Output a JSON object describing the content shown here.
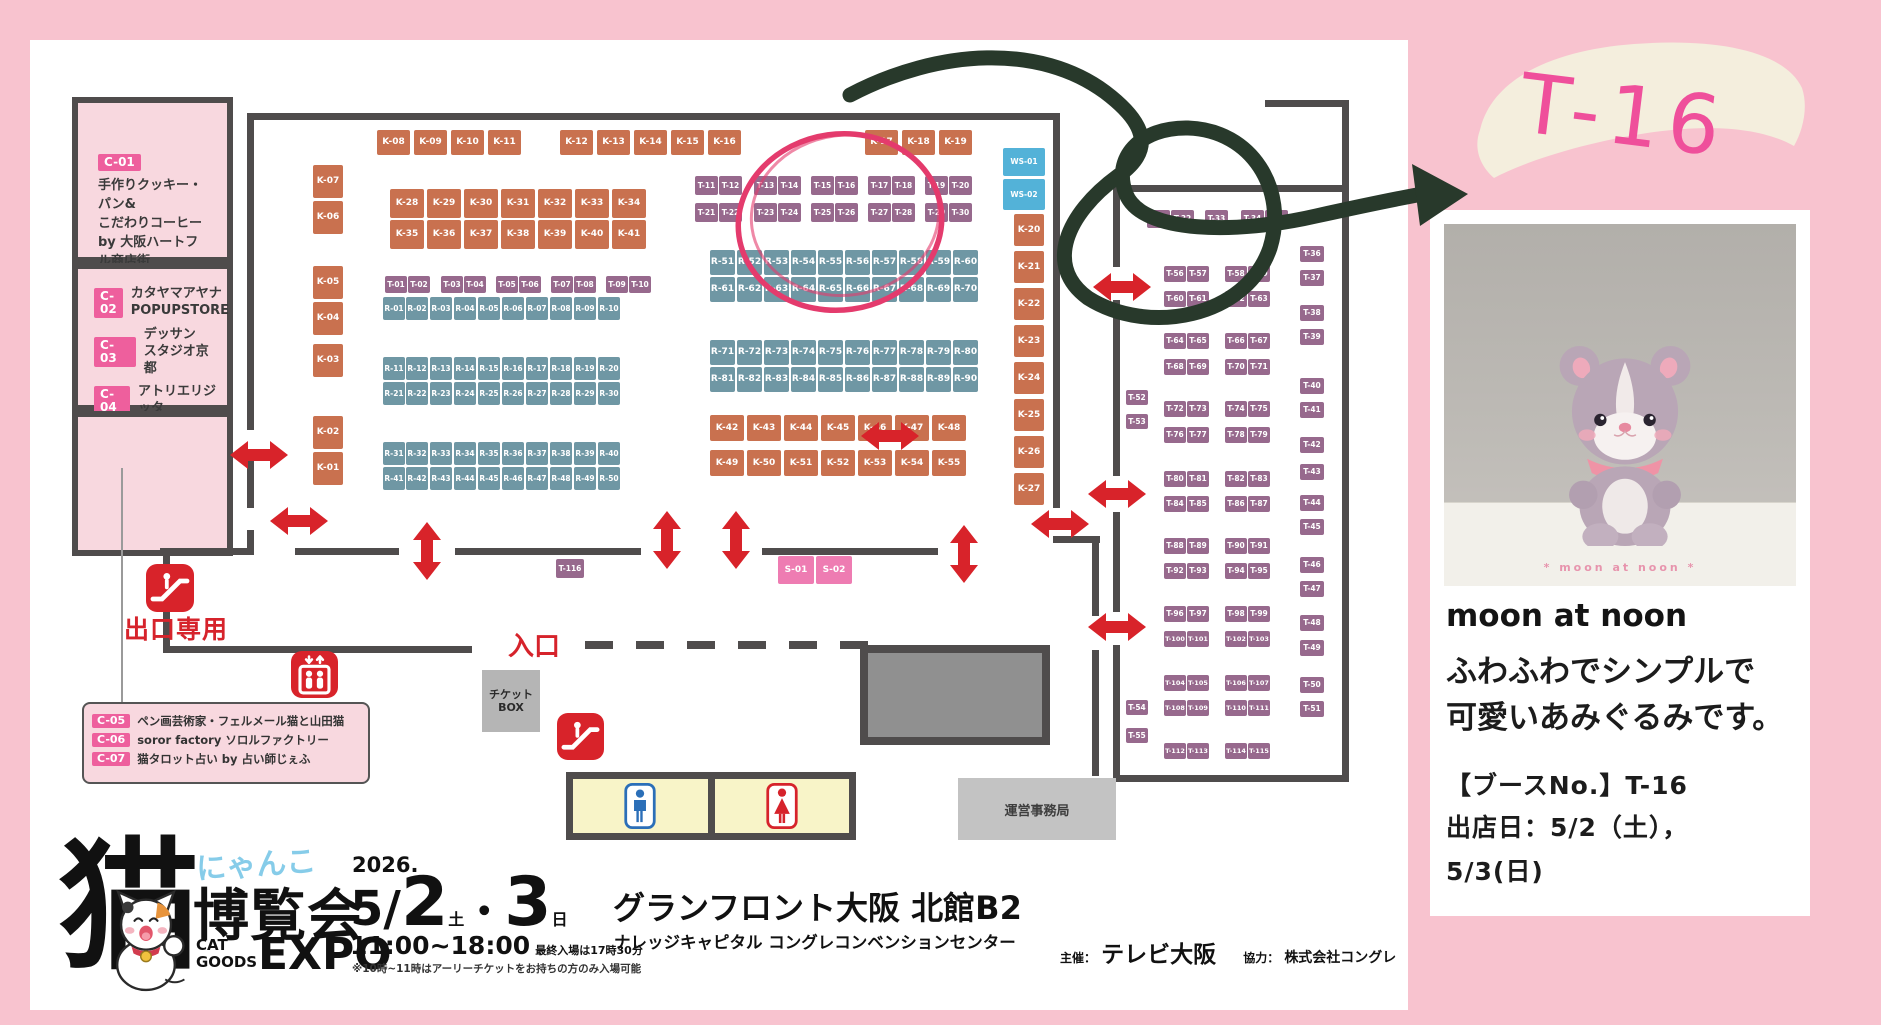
{
  "colors": {
    "k": "#c9714f",
    "r": "#6f97a4",
    "t": "#97698d",
    "ws": "#53b2d8",
    "s": "#ee7cb2",
    "wall": "#4f4c4c",
    "red": "#d8232a",
    "pink_room": "#f8d8df",
    "badge": "#ee5f9d",
    "background": "#f8c3cf",
    "accent_pink": "#ef4f9b",
    "green_marker": "#28392b",
    "red_marker": "#e43b6d"
  },
  "rooms": {
    "c01": {
      "badge": "C-01",
      "l1": "手作りクッキー・パン&",
      "l2": "こだわりコーヒー",
      "l3": "by 大阪ハートフル商店街"
    },
    "c02": {
      "badge": "C-02",
      "l1": "カタヤマアヤナ",
      "l2": "POPUPSTORE"
    },
    "c03": {
      "badge": "C-03",
      "l1": "デッサン",
      "l2": "スタジオ京都"
    },
    "c04": {
      "badge": "C-04",
      "l1": "アトリエリジッタ"
    },
    "c05": {
      "badge": "C-05",
      "text": "ペン画芸術家・フェルメール猫と山田猫"
    },
    "c06": {
      "badge": "C-06",
      "text": "soror factory ソロルファクトリー"
    },
    "c07": {
      "badge": "C-07",
      "text": "猫タロット占い by 占い師じぇふ"
    }
  },
  "map": {
    "labels": {
      "exit": "出口専用",
      "entrance": "入口",
      "ticket1": "チケット",
      "ticket2": "BOX",
      "office": "運営事務局"
    },
    "booth_rows": [
      {
        "ids": [
          "K-08",
          "K-09",
          "K-10",
          "K-11"
        ],
        "xs": [
          377,
          414,
          451,
          488
        ],
        "y": 130,
        "w": 33,
        "h": 25,
        "t": "k"
      },
      {
        "ids": [
          "K-12",
          "K-13",
          "K-14",
          "K-15",
          "K-16"
        ],
        "xs": [
          560,
          597,
          634,
          671,
          708
        ],
        "y": 130,
        "w": 33,
        "h": 25,
        "t": "k"
      },
      {
        "ids": [
          "K-17",
          "K-18",
          "K-19"
        ],
        "xs": [
          865,
          902,
          939
        ],
        "y": 130,
        "w": 33,
        "h": 25,
        "t": "k"
      },
      {
        "ids": [
          "K-07",
          "K-06",
          "K-05",
          "K-04",
          "K-03",
          "K-02",
          "K-01"
        ],
        "x": 313,
        "ys": [
          165,
          201,
          266,
          302,
          344,
          416,
          452
        ],
        "w": 30,
        "h": 33,
        "t": "k"
      },
      {
        "ids": [
          "K-28",
          "K-29",
          "K-30",
          "K-31",
          "K-32",
          "K-33",
          "K-34"
        ],
        "xs": [
          390,
          427,
          464,
          501,
          538,
          575,
          612
        ],
        "y": 189,
        "w": 34,
        "h": 29,
        "t": "k"
      },
      {
        "ids": [
          "K-35",
          "K-36",
          "K-37",
          "K-38",
          "K-39",
          "K-40",
          "K-41"
        ],
        "xs": [
          390,
          427,
          464,
          501,
          538,
          575,
          612
        ],
        "y": 220,
        "w": 34,
        "h": 29,
        "t": "k"
      },
      {
        "ids": [
          "T-01",
          "T-02",
          "T-03",
          "T-04",
          "T-05",
          "T-06",
          "T-07",
          "T-08",
          "T-09",
          "T-10"
        ],
        "xs": [
          385,
          408,
          441,
          464,
          496,
          519,
          551,
          574,
          606,
          629
        ],
        "y": 276,
        "w": 22,
        "h": 17,
        "t": "t"
      },
      {
        "ids": [
          "R-01",
          "R-02",
          "R-03",
          "R-04",
          "R-05",
          "R-06",
          "R-07",
          "R-08",
          "R-09",
          "R-10"
        ],
        "xs": [
          383,
          406,
          430,
          454,
          478,
          502,
          526,
          550,
          574,
          598
        ],
        "y": 297,
        "w": 22,
        "h": 23,
        "t": "r"
      },
      {
        "ids": [
          "R-11",
          "R-12",
          "R-13",
          "R-14",
          "R-15",
          "R-16",
          "R-17",
          "R-18",
          "R-19",
          "R-20"
        ],
        "xs": [
          383,
          406,
          430,
          454,
          478,
          502,
          526,
          550,
          574,
          598
        ],
        "y": 357,
        "w": 22,
        "h": 23,
        "t": "r"
      },
      {
        "ids": [
          "R-21",
          "R-22",
          "R-23",
          "R-24",
          "R-25",
          "R-26",
          "R-27",
          "R-28",
          "R-29",
          "R-30"
        ],
        "xs": [
          383,
          406,
          430,
          454,
          478,
          502,
          526,
          550,
          574,
          598
        ],
        "y": 382,
        "w": 22,
        "h": 23,
        "t": "r"
      },
      {
        "ids": [
          "R-31",
          "R-32",
          "R-33",
          "R-34",
          "R-35",
          "R-36",
          "R-37",
          "R-38",
          "R-39",
          "R-40"
        ],
        "xs": [
          383,
          406,
          430,
          454,
          478,
          502,
          526,
          550,
          574,
          598
        ],
        "y": 442,
        "w": 22,
        "h": 23,
        "t": "r"
      },
      {
        "ids": [
          "R-41",
          "R-42",
          "R-43",
          "R-44",
          "R-45",
          "R-46",
          "R-47",
          "R-48",
          "R-49",
          "R-50"
        ],
        "xs": [
          383,
          406,
          430,
          454,
          478,
          502,
          526,
          550,
          574,
          598
        ],
        "y": 467,
        "w": 22,
        "h": 23,
        "t": "r"
      },
      {
        "ids": [
          "T-11",
          "T-12",
          "T-13",
          "T-14",
          "T-15",
          "T-16",
          "T-17",
          "T-18",
          "T-19",
          "T-20"
        ],
        "xs": [
          695,
          719,
          754,
          778,
          811,
          835,
          868,
          892,
          925,
          949
        ],
        "y": 176,
        "w": 23,
        "h": 19,
        "t": "t"
      },
      {
        "ids": [
          "T-21",
          "T-22",
          "T-23",
          "T-24",
          "T-25",
          "T-26",
          "T-27",
          "T-28",
          "T-29",
          "T-30"
        ],
        "xs": [
          695,
          719,
          754,
          778,
          811,
          835,
          868,
          892,
          925,
          949
        ],
        "y": 203,
        "w": 23,
        "h": 19,
        "t": "t"
      },
      {
        "ids": [
          "R-51",
          "R-52",
          "R-53",
          "R-54",
          "R-55",
          "R-56",
          "R-57",
          "R-58",
          "R-59",
          "R-60"
        ],
        "xs": [
          710,
          737,
          764,
          791,
          818,
          845,
          872,
          899,
          926,
          953
        ],
        "y": 250,
        "w": 25,
        "h": 25,
        "t": "r"
      },
      {
        "ids": [
          "R-61",
          "R-62",
          "R-63",
          "R-64",
          "R-65",
          "R-66",
          "R-67",
          "R-68",
          "R-69",
          "R-70"
        ],
        "xs": [
          710,
          737,
          764,
          791,
          818,
          845,
          872,
          899,
          926,
          953
        ],
        "y": 277,
        "w": 25,
        "h": 25,
        "t": "r"
      },
      {
        "ids": [
          "R-71",
          "R-72",
          "R-73",
          "R-74",
          "R-75",
          "R-76",
          "R-77",
          "R-78",
          "R-79",
          "R-80"
        ],
        "xs": [
          710,
          737,
          764,
          791,
          818,
          845,
          872,
          899,
          926,
          953
        ],
        "y": 340,
        "w": 25,
        "h": 25,
        "t": "r"
      },
      {
        "ids": [
          "R-81",
          "R-82",
          "R-83",
          "R-84",
          "R-85",
          "R-86",
          "R-87",
          "R-88",
          "R-89",
          "R-90"
        ],
        "xs": [
          710,
          737,
          764,
          791,
          818,
          845,
          872,
          899,
          926,
          953
        ],
        "y": 367,
        "w": 25,
        "h": 25,
        "t": "r"
      },
      {
        "ids": [
          "K-42",
          "K-43",
          "K-44",
          "K-45",
          "K-46",
          "K-47",
          "K-48"
        ],
        "xs": [
          710,
          747,
          784,
          821,
          858,
          895,
          932
        ],
        "y": 415,
        "w": 34,
        "h": 26,
        "t": "k"
      },
      {
        "ids": [
          "K-49",
          "K-50",
          "K-51",
          "K-52",
          "K-53",
          "K-54",
          "K-55"
        ],
        "xs": [
          710,
          747,
          784,
          821,
          858,
          895,
          932
        ],
        "y": 450,
        "w": 34,
        "h": 26,
        "t": "k"
      },
      {
        "ids": [
          "WS-01"
        ],
        "xs": [
          1003
        ],
        "y": 148,
        "w": 42,
        "h": 28,
        "t": "ws"
      },
      {
        "ids": [
          "WS-02"
        ],
        "xs": [
          1003
        ],
        "y": 179,
        "w": 42,
        "h": 31,
        "t": "ws"
      },
      {
        "ids": [
          "K-20",
          "K-21",
          "K-22",
          "K-23",
          "K-24",
          "K-25",
          "K-26",
          "K-27"
        ],
        "x": 1014,
        "ys": [
          214,
          251,
          288,
          325,
          362,
          399,
          436,
          473
        ],
        "w": 30,
        "h": 32,
        "t": "k"
      },
      {
        "ids": [
          "S-01",
          "S-02"
        ],
        "xs": [
          778,
          816
        ],
        "y": 556,
        "w": 36,
        "h": 28,
        "t": "s"
      },
      {
        "ids": [
          "T-116"
        ],
        "xs": [
          556
        ],
        "y": 559,
        "w": 28,
        "h": 19,
        "t": "t"
      },
      {
        "ids": [
          "T-31",
          "T-32",
          "T-33",
          "T-34",
          "T-35"
        ],
        "xs": [
          1147,
          1171,
          1205,
          1241,
          1265
        ],
        "y": 210,
        "w": 23,
        "h": 18,
        "t": "t"
      },
      {
        "ids": [
          "T-36",
          "T-37",
          "T-38",
          "T-39",
          "T-40",
          "T-41",
          "T-42",
          "T-43",
          "T-44",
          "T-45",
          "T-46",
          "T-47",
          "T-48",
          "T-49",
          "T-50",
          "T-51"
        ],
        "x": 1300,
        "ys": [
          246,
          270,
          305,
          329,
          378,
          402,
          437,
          464,
          495,
          519,
          557,
          581,
          615,
          640,
          677,
          701
        ],
        "w": 24,
        "h": 16,
        "t": "t"
      },
      {
        "ids": [
          "T-52",
          "T-53"
        ],
        "x": 1126,
        "ys": [
          390,
          414
        ],
        "w": 22,
        "h": 15,
        "t": "t"
      },
      {
        "ids": [
          "T-54",
          "T-55"
        ],
        "x": 1126,
        "ys": [
          700,
          728
        ],
        "w": 22,
        "h": 15,
        "t": "t"
      },
      {
        "ids": [
          "T-56",
          "T-57",
          "T-58",
          "T-59"
        ],
        "xs": [
          1164,
          1187,
          1225,
          1248
        ],
        "y": 266,
        "w": 22,
        "h": 16,
        "t": "t"
      },
      {
        "ids": [
          "T-60",
          "T-61",
          "T-62",
          "T-63"
        ],
        "xs": [
          1164,
          1187,
          1225,
          1248
        ],
        "y": 291,
        "w": 22,
        "h": 16,
        "t": "t"
      },
      {
        "ids": [
          "T-64",
          "T-65",
          "T-66",
          "T-67"
        ],
        "xs": [
          1164,
          1187,
          1225,
          1248
        ],
        "y": 333,
        "w": 22,
        "h": 16,
        "t": "t"
      },
      {
        "ids": [
          "T-68",
          "T-69",
          "T-70",
          "T-71"
        ],
        "xs": [
          1164,
          1187,
          1225,
          1248
        ],
        "y": 359,
        "w": 22,
        "h": 16,
        "t": "t"
      },
      {
        "ids": [
          "T-72",
          "T-73",
          "T-74",
          "T-75"
        ],
        "xs": [
          1164,
          1187,
          1225,
          1248
        ],
        "y": 401,
        "w": 22,
        "h": 16,
        "t": "t"
      },
      {
        "ids": [
          "T-76",
          "T-77",
          "T-78",
          "T-79"
        ],
        "xs": [
          1164,
          1187,
          1225,
          1248
        ],
        "y": 427,
        "w": 22,
        "h": 16,
        "t": "t"
      },
      {
        "ids": [
          "T-80",
          "T-81",
          "T-82",
          "T-83"
        ],
        "xs": [
          1164,
          1187,
          1225,
          1248
        ],
        "y": 471,
        "w": 22,
        "h": 16,
        "t": "t"
      },
      {
        "ids": [
          "T-84",
          "T-85",
          "T-86",
          "T-87"
        ],
        "xs": [
          1164,
          1187,
          1225,
          1248
        ],
        "y": 496,
        "w": 22,
        "h": 16,
        "t": "t"
      },
      {
        "ids": [
          "T-88",
          "T-89",
          "T-90",
          "T-91"
        ],
        "xs": [
          1164,
          1187,
          1225,
          1248
        ],
        "y": 538,
        "w": 22,
        "h": 16,
        "t": "t"
      },
      {
        "ids": [
          "T-92",
          "T-93",
          "T-94",
          "T-95"
        ],
        "xs": [
          1164,
          1187,
          1225,
          1248
        ],
        "y": 563,
        "w": 22,
        "h": 16,
        "t": "t"
      },
      {
        "ids": [
          "T-96",
          "T-97",
          "T-98",
          "T-99"
        ],
        "xs": [
          1164,
          1187,
          1225,
          1248
        ],
        "y": 606,
        "w": 22,
        "h": 16,
        "t": "t"
      },
      {
        "ids": [
          "T-100",
          "T-101",
          "T-102",
          "T-103"
        ],
        "xs": [
          1164,
          1187,
          1225,
          1248
        ],
        "y": 631,
        "w": 22,
        "h": 16,
        "t": "t"
      },
      {
        "ids": [
          "T-104",
          "T-105",
          "T-106",
          "T-107"
        ],
        "xs": [
          1164,
          1187,
          1225,
          1248
        ],
        "y": 675,
        "w": 22,
        "h": 16,
        "t": "t"
      },
      {
        "ids": [
          "T-108",
          "T-109",
          "T-110",
          "T-111"
        ],
        "xs": [
          1164,
          1187,
          1225,
          1248
        ],
        "y": 700,
        "w": 22,
        "h": 16,
        "t": "t"
      },
      {
        "ids": [
          "T-112",
          "T-113",
          "T-114",
          "T-115"
        ],
        "xs": [
          1164,
          1187,
          1225,
          1248
        ],
        "y": 743,
        "w": 22,
        "h": 16,
        "t": "t"
      }
    ],
    "walls": [
      [
        247,
        113,
        813,
        7
      ],
      [
        247,
        120,
        7,
        310
      ],
      [
        247,
        458,
        7,
        50
      ],
      [
        247,
        530,
        7,
        25
      ],
      [
        160,
        548,
        90,
        7
      ],
      [
        295,
        548,
        104,
        7
      ],
      [
        455,
        548,
        186,
        7
      ],
      [
        762,
        548,
        176,
        7
      ],
      [
        163,
        553,
        7,
        100
      ],
      [
        163,
        646,
        309,
        7
      ],
      [
        1053,
        113,
        7,
        395
      ],
      [
        1053,
        536,
        47,
        7
      ],
      [
        1092,
        536,
        7,
        80
      ],
      [
        1092,
        650,
        7,
        126
      ],
      [
        1113,
        185,
        236,
        7
      ],
      [
        1342,
        185,
        7,
        597
      ],
      [
        1113,
        775,
        236,
        7
      ],
      [
        1113,
        192,
        7,
        75
      ],
      [
        1113,
        300,
        7,
        176
      ],
      [
        1113,
        512,
        7,
        100
      ],
      [
        1113,
        645,
        7,
        130
      ],
      [
        1265,
        100,
        84,
        7
      ],
      [
        1342,
        100,
        7,
        92
      ]
    ],
    "dashes": [
      [
        585,
        641,
        28,
        8
      ],
      [
        636,
        641,
        28,
        8
      ],
      [
        687,
        641,
        28,
        8
      ],
      [
        738,
        641,
        28,
        8
      ],
      [
        789,
        641,
        28,
        8
      ],
      [
        840,
        641,
        28,
        8
      ]
    ],
    "arrows": {
      "h": [
        [
          259,
          455
        ],
        [
          299,
          521
        ],
        [
          890,
          436
        ],
        [
          1060,
          524
        ],
        [
          1122,
          287
        ],
        [
          1117,
          494
        ],
        [
          1117,
          627
        ]
      ],
      "v": [
        [
          427,
          551
        ],
        [
          667,
          540
        ],
        [
          736,
          540
        ],
        [
          964,
          554
        ]
      ]
    },
    "icons": [
      [
        "escalator",
        146,
        564,
        48
      ],
      [
        "elevator",
        291,
        651,
        47
      ],
      [
        "escalator",
        557,
        713,
        47
      ]
    ]
  },
  "footer": {
    "brand": {
      "kanji": "猫",
      "nyanko": "にゃんこ",
      "hakurankai": "博覧会",
      "cat": "CAT",
      "goods": "GOODS",
      "expo": "EXPO"
    },
    "date": {
      "year": "2026.",
      "month": "5/",
      "day1": "2",
      "day1_sub": "土",
      "dot": "・",
      "day2": "3",
      "day2_sub": "日",
      "time": "11:00~18:00",
      "last_entry": "最終入場は17時30分",
      "note": "※10時~11時はアーリーチケットをお持ちの方のみ入場可能"
    },
    "venue": {
      "name": "グランフロント大阪 北館B2",
      "sub": "ナレッジキャピタル コングレコンベンションセンター",
      "org_label": "主催：",
      "org": "テレビ大阪",
      "coop_label": "協力：",
      "coop": "株式会社コングレ"
    }
  },
  "sidebar": {
    "tag": "T-16",
    "photo_caption": "* moon at noon *",
    "title": "moon at noon",
    "desc1": "ふわふわでシンプルで",
    "desc2": "可愛いあみぐるみです。",
    "booth_no": "【ブースNo.】T-16",
    "date1": "出店日：5/2（土），",
    "date2": "5/3(日)"
  }
}
